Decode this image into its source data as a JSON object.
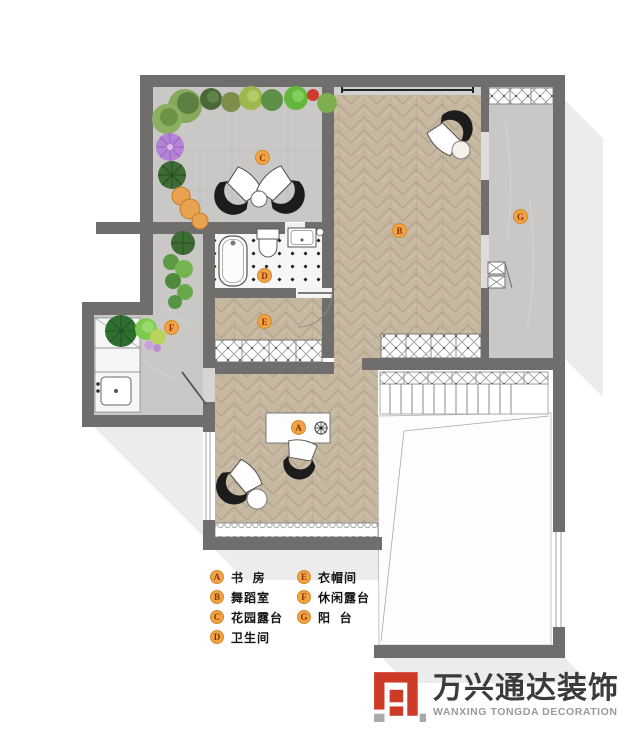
{
  "rooms": [
    {
      "letter": "A",
      "name": "书  房"
    },
    {
      "letter": "B",
      "name": "舞蹈室"
    },
    {
      "letter": "C",
      "name": "花园露台"
    },
    {
      "letter": "D",
      "name": "卫生间"
    },
    {
      "letter": "E",
      "name": "衣帽间"
    },
    {
      "letter": "F",
      "name": "休闲露台"
    },
    {
      "letter": "G",
      "name": "阳  台"
    }
  ],
  "logo": {
    "cn": "万兴通达装饰",
    "en": "WANXING TONGDA DECORATION"
  },
  "colors": {
    "wall": "#6f6e6c",
    "wood": "#c6b7a1",
    "stone": "#c9c8c6",
    "bath_tile": "#f6f6f6",
    "label_bg": "#f2a444",
    "label_border": "#cf8a2c",
    "label_text": "#86320c",
    "logo_red": "#cd3a27",
    "logo_dark": "#3b3b3b",
    "logo_gray": "#9a9a9a"
  }
}
